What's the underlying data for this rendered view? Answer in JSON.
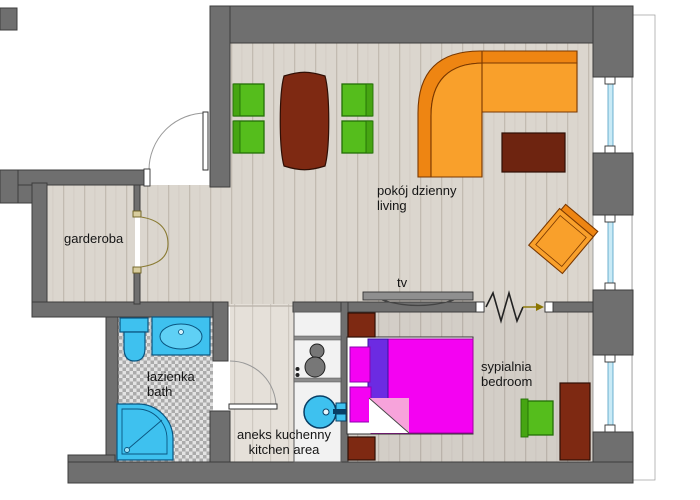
{
  "meta": {
    "type": "apartment-floor-plan",
    "languages": "Polish / English"
  },
  "labels": {
    "garderoba": "garderoba",
    "living_pl": "pokój dzienny",
    "living_en": "living",
    "tv": "tv",
    "bath_pl": "łazienka",
    "bath_en": "bath",
    "kitchen_pl": "aneks kuchenny",
    "kitchen_en": "kitchen area",
    "bedroom_pl": "sypialnia",
    "bedroom_en": "bedroom"
  },
  "colors": {
    "wall": "#6F6F6F",
    "wall_outline": "#3C3C3C",
    "floor_living": "#DBD6CE",
    "floor_bedroom": "#D3CEC7",
    "floor_kitchen": "#E5E0D9",
    "tile_light": "#E3E3E3",
    "tile_dark": "#ABABAB",
    "sofa_orange": "#F9A02B",
    "sofa_orange_dark": "#EE8512",
    "wood_dark_red": "#7E2912",
    "chair_green": "#55BD1C",
    "bed_magenta": "#F402F2",
    "pillow_purple": "#6C2BE2",
    "blanket_pink": "#F7A3DB",
    "fixture_cyan": "#3EC1EF",
    "fixture_outline": "#0A5580",
    "glass_blue": "#C9EAF6"
  }
}
